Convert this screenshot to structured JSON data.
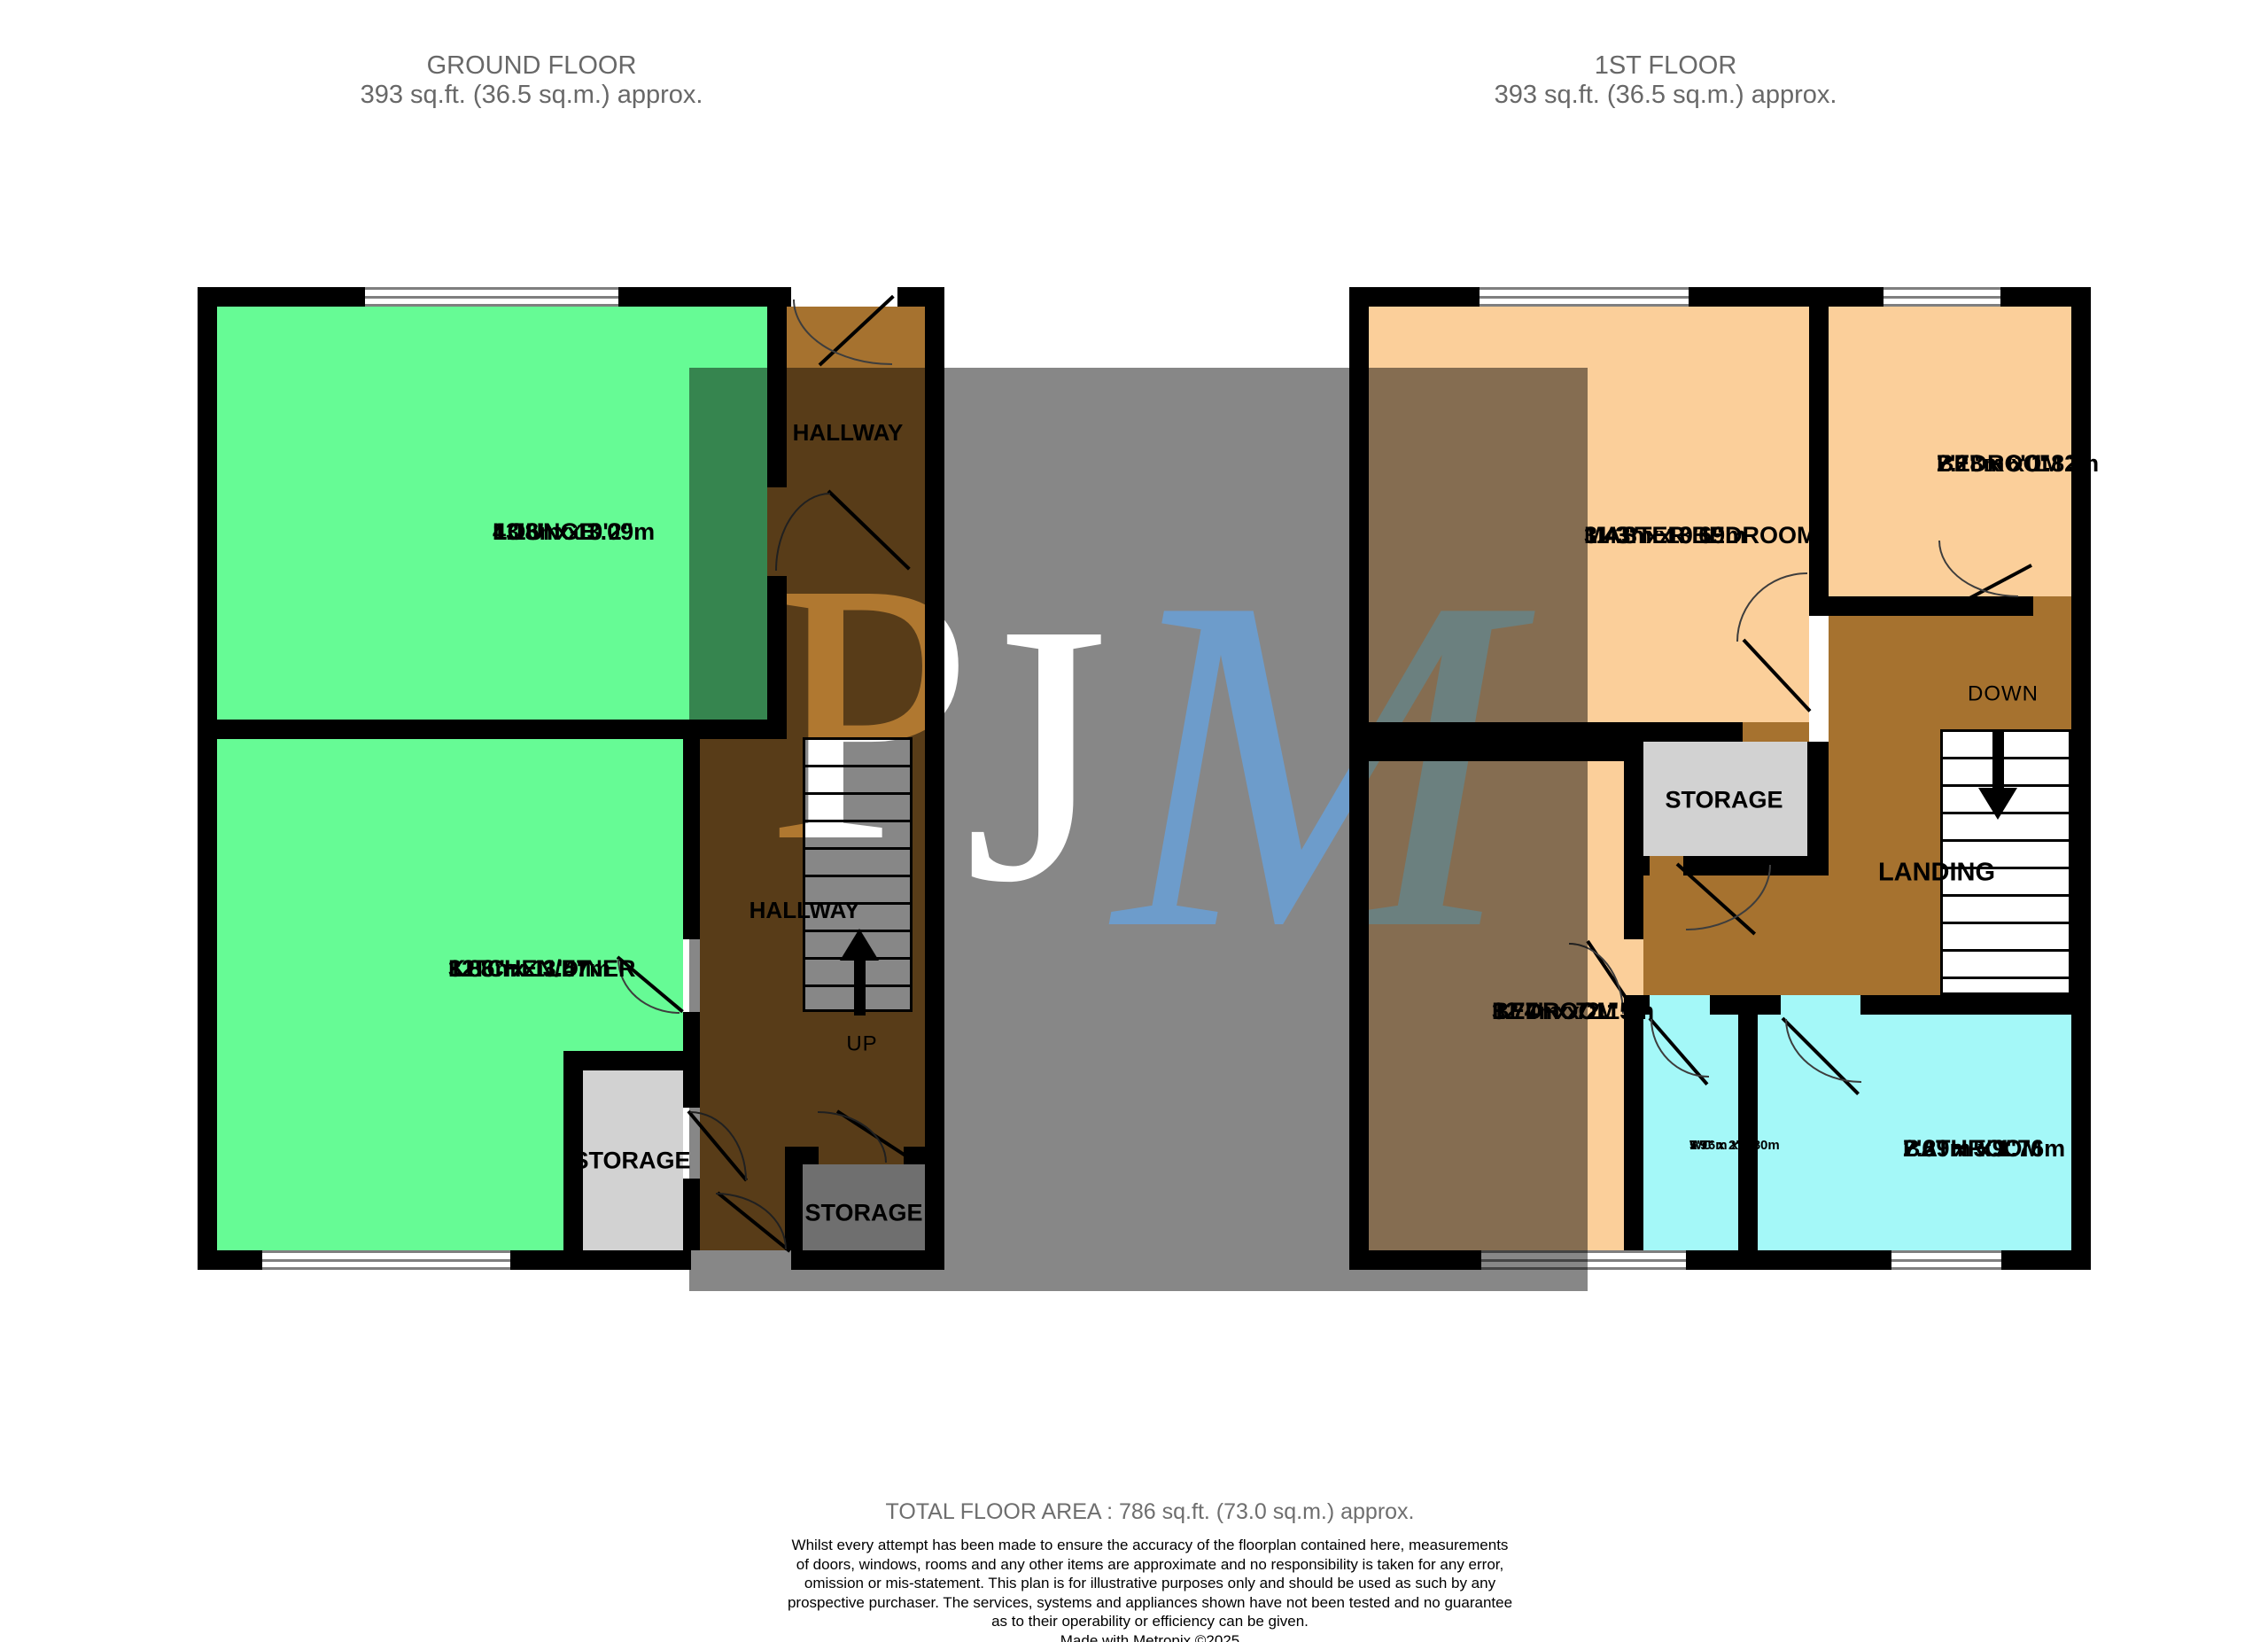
{
  "titles": {
    "ground": {
      "line1": "GROUND FLOOR",
      "line2": "393 sq.ft. (36.5 sq.m.) approx."
    },
    "first": {
      "line1": "1ST FLOOR",
      "line2": "393 sq.ft. (36.5 sq.m.) approx."
    }
  },
  "ground": {
    "rooms": {
      "lounge": {
        "name": "LOUNGE",
        "imperial": "13'8\"  x 10'2\"",
        "metric": "4.16m  x 3.09m"
      },
      "kitchen": {
        "name": "KITCHEN/DINER",
        "imperial": "12'8\"  x 11'5\"",
        "metric": "3.86m  x 3.47m"
      },
      "hallway_upper": {
        "name": "HALLWAY"
      },
      "hallway_lower": {
        "name": "HALLWAY"
      },
      "storage_left": {
        "name": "STORAGE"
      },
      "storage_right": {
        "name": "STORAGE"
      }
    },
    "stairs_up_label": "UP"
  },
  "first": {
    "rooms": {
      "master": {
        "name": "MASTER BEDROOM",
        "imperial": "11'3\"  x 10'6\"",
        "metric": "3.43m  x 3.19m"
      },
      "bedroom3": {
        "name": "BEDROOM 3",
        "imperial": "7'2\"  x 6'0\"",
        "metric": "2.18m  x 1.82m"
      },
      "bedroom2": {
        "name": "BEDROOM 2",
        "imperial": "12'4\"  x 7'1\"",
        "metric": "3.77m  x 2.15m"
      },
      "storage": {
        "name": "STORAGE"
      },
      "landing": {
        "name": "LANDING"
      },
      "wc": {
        "name": "WC",
        "imperial": "5'9\"  x 2'8\"",
        "metric": "1.76m  x 0.80m"
      },
      "bathroom": {
        "name": "BATHROOM",
        "imperial": "7'6\"  x 5'9\"",
        "metric": "2.29m  x 1.76m"
      }
    },
    "stairs_down_label": "DOWN"
  },
  "watermark": {
    "letters": [
      {
        "char": "P",
        "color": "#ffffff"
      },
      {
        "char": "J",
        "color": "#ffffff"
      },
      {
        "char": "M",
        "color": "#6496c8"
      }
    ]
  },
  "footer": {
    "total_area": "TOTAL FLOOR AREA : 786 sq.ft. (73.0 sq.m.) approx.",
    "disclaimer": [
      "Whilst every attempt has been made to ensure the accuracy of the floorplan contained here, measurements",
      "of doors, windows, rooms and any other items are approximate and no responsibility is taken for any error,",
      "omission or mis-statement. This plan is for illustrative purposes only and should be used as such by any",
      "prospective purchaser. The services, systems and appliances shown have not been tested and no guarantee",
      "as to their operability or efficiency can be given."
    ],
    "credit": "Made with Metropix ©2025"
  },
  "colors": {
    "room_green": "#66fb95",
    "hallway_brown": "#a6722f",
    "bedroom_peach": "#fbcf9a",
    "bathroom_cyan": "#a4f8f8",
    "storage_gray": "#d2d2d2",
    "wall_black": "#000000",
    "watermark_overlay": "rgba(0,0,0,0.47)",
    "watermark_blue": "#6496c8"
  }
}
